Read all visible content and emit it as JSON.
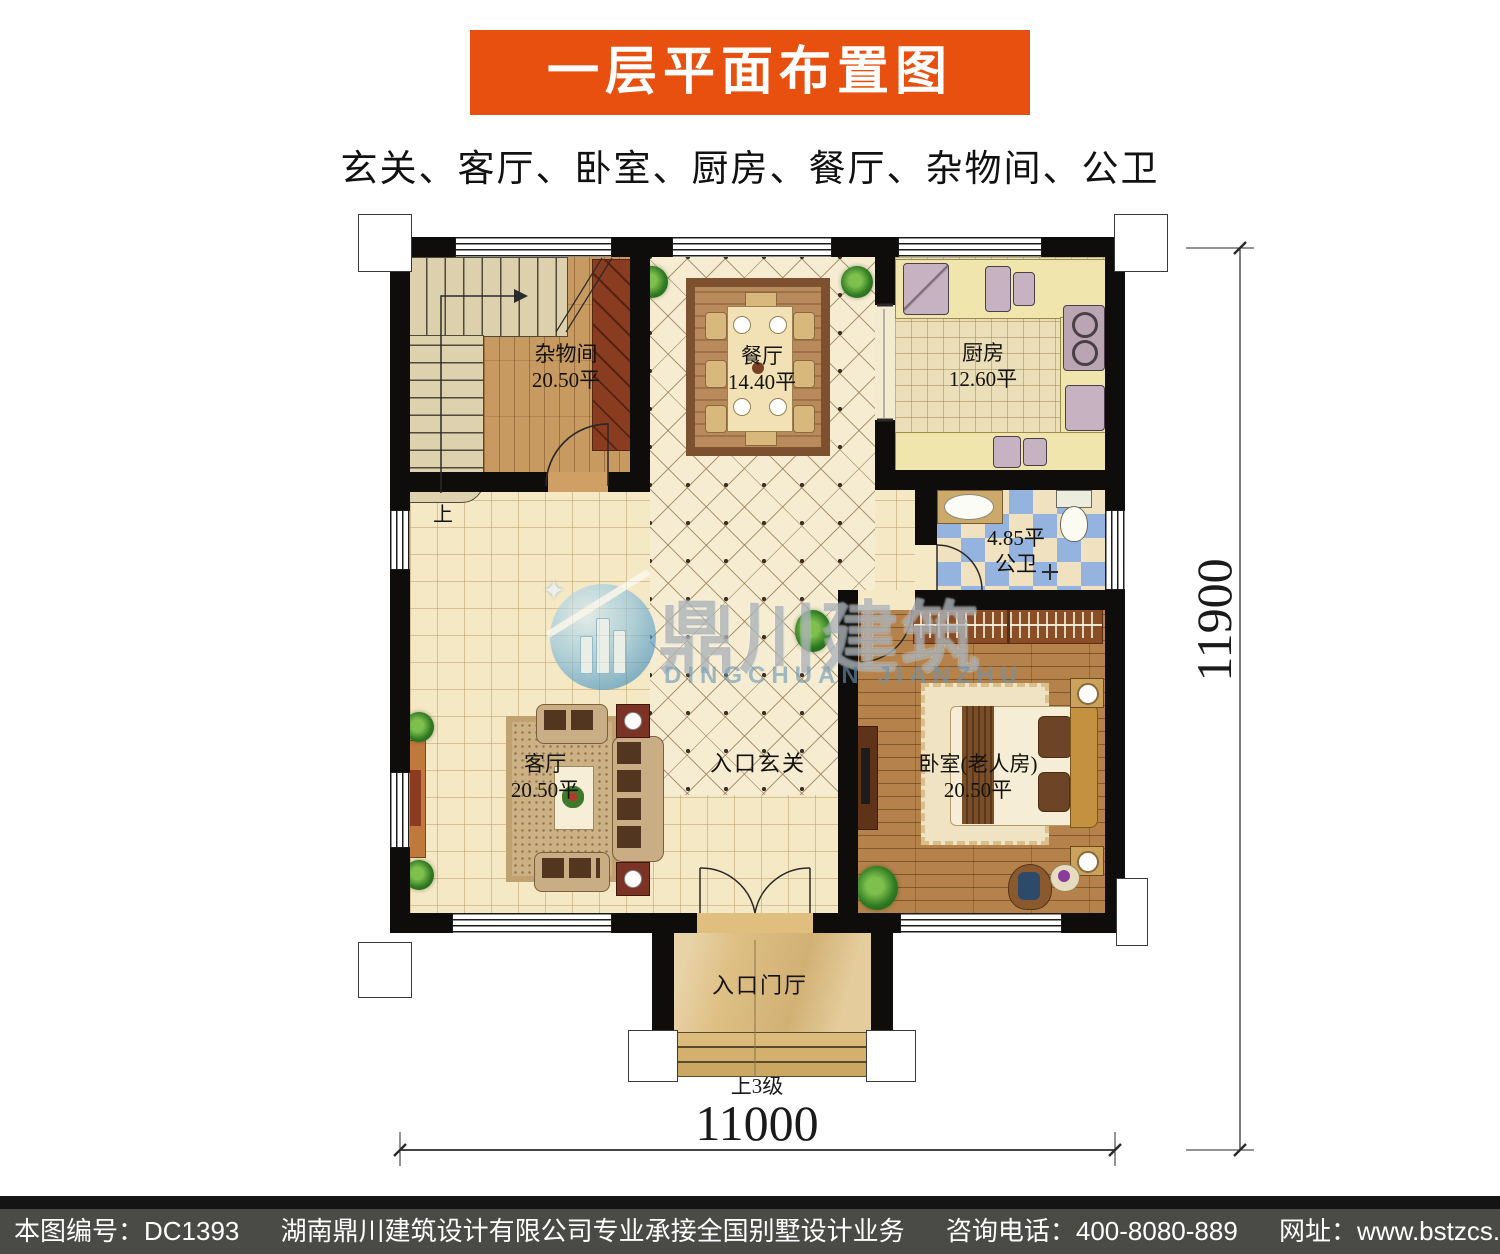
{
  "header": {
    "title": "一层平面布置图",
    "subtitle": "玄关、客厅、卧室、厨房、餐厅、杂物间、公卫"
  },
  "plan": {
    "rooms": {
      "storage": {
        "name": "杂物间",
        "area": "20.50平"
      },
      "dining": {
        "name": "餐厅",
        "area": "14.40平"
      },
      "kitchen": {
        "name": "厨房",
        "area": "12.60平"
      },
      "bath": {
        "name": "公卫",
        "area": "4.85平"
      },
      "living": {
        "name": "客厅",
        "area": "20.50平"
      },
      "bedroom": {
        "name": "卧室(老人房)",
        "area": "20.50平"
      },
      "hall": {
        "name": "入口玄关"
      },
      "porch": {
        "name": "入口门厅"
      }
    },
    "stair_up_label": "上",
    "porch_steps_label": "上3级",
    "dim_width": "11000",
    "dim_height": "11900"
  },
  "watermark": {
    "cn": "鼎川建筑",
    "en": "DINGCHUAN JIANZHU"
  },
  "footer": {
    "seg_code": "本图编号：DC1393",
    "seg_company": "湖南鼎川建筑设计有限公司专业承接全国别墅设计业务",
    "seg_phone": "咨询电话：400-8080-889",
    "seg_web": "网址：www.bstzcs.com"
  },
  "colors": {
    "banner_orange": "#E8500F",
    "footer_gray": "#4A4A47",
    "wall_black": "#0E0D0B",
    "floor_cream": "#F5E8C4",
    "bath_blue": "#94B4DF",
    "watermark_blue": "#5B9EC9"
  }
}
